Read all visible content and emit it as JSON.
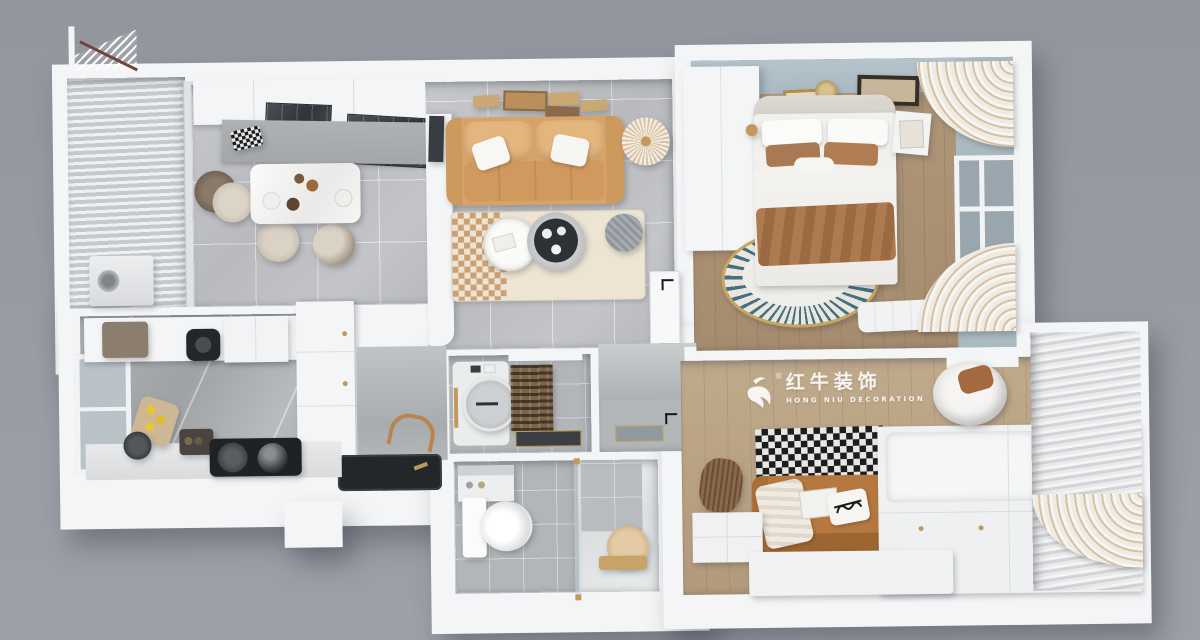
{
  "watermark": {
    "registered": "®",
    "title": "红牛装饰",
    "subtitle": "HONG NIU DECORATION"
  },
  "palette": {
    "bg-top": "#93969e",
    "bg-bot": "#9da0a8",
    "wall": "#f4f5f6",
    "tile": "#bfc1c4",
    "wood-master": "#b0977a",
    "wood-second": "#c0aa8c",
    "wall-blue": "#b5c3cc",
    "window-blue": "#abb9c0",
    "sofa-tan": "#d7a368",
    "sofa-tan-light": "#e3b67e",
    "caramel": "#b5793f",
    "blanket-brown": "#a97953",
    "rug-cream": "#eee4d4",
    "checker-dark": "#1c1d1f",
    "gold": "#c0995c",
    "glass-dark": "#343a40",
    "counter-gray": "#a3a7aa",
    "appliance-dark": "#24272a",
    "watermark": "#ffffff"
  }
}
